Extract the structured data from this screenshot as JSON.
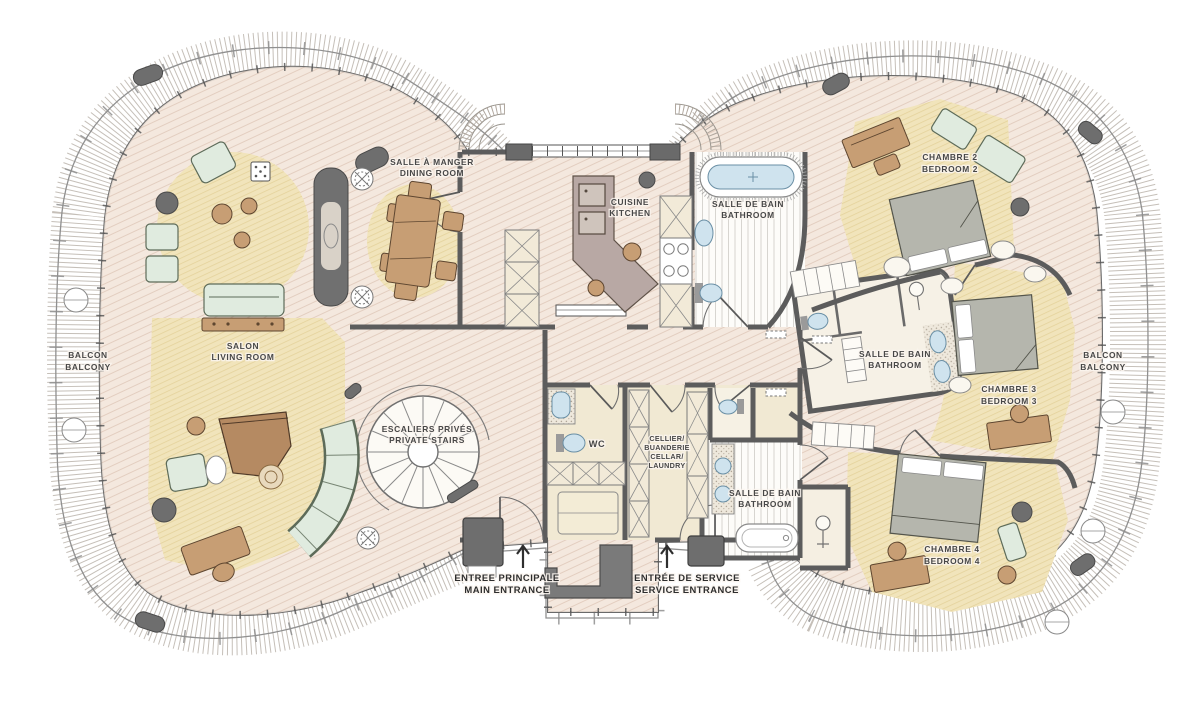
{
  "palette": {
    "floor": "#f4e8de",
    "floor_hatch": "#e3cec0",
    "rug": "#f1e4bb",
    "wall": "#5c5c5c",
    "wood_furniture": "#c79e74",
    "fabric_furniture": "#e0ebdf",
    "bed_gray": "#b5b6ad",
    "water_blue": "#cfe3ee",
    "label_text": "#474747"
  },
  "rooms": {
    "dining": {
      "fr": "SALLE À MANGER",
      "en": "DINING ROOM"
    },
    "kitchen": {
      "fr": "CUISINE",
      "en": "KITCHEN"
    },
    "bathroom_top": {
      "fr": "SALLE DE BAIN",
      "en": "BATHROOM"
    },
    "bedroom2": {
      "fr": "CHAMBRE 2",
      "en": "BEDROOM 2"
    },
    "balcony_left": {
      "fr": "BALCON",
      "en": "BALCONY"
    },
    "salon": {
      "fr": "SALON",
      "en": "LIVING ROOM"
    },
    "bathroom_mid": {
      "fr": "SALLE DE BAIN",
      "en": "BATHROOM"
    },
    "bedroom3": {
      "fr": "CHAMBRE 3",
      "en": "BEDROOM 3"
    },
    "balcony_right": {
      "fr": "BALCON",
      "en": "BALCONY"
    },
    "stairs": {
      "fr": "ESCALIERS PRIVÉS",
      "en": "PRIVATE STAIRS"
    },
    "wc": {
      "label": "WC"
    },
    "cellar": {
      "lines": [
        "CELLIER/",
        "BUANDERIE",
        "CELLAR/",
        "LAUNDRY"
      ]
    },
    "bathroom_bottom": {
      "fr": "SALLE DE BAIN",
      "en": "BATHROOM"
    },
    "bedroom4": {
      "fr": "CHAMBRE 4",
      "en": "BEDROOM 4"
    }
  },
  "entrances": {
    "main": {
      "fr": "ENTREE PRINCIPALE",
      "en": "MAIN ENTRANCE",
      "arrow": "↑"
    },
    "service": {
      "fr": "ENTRÉE DE SERVICE",
      "en": "SERVICE ENTRANCE",
      "arrow": "↑"
    }
  }
}
